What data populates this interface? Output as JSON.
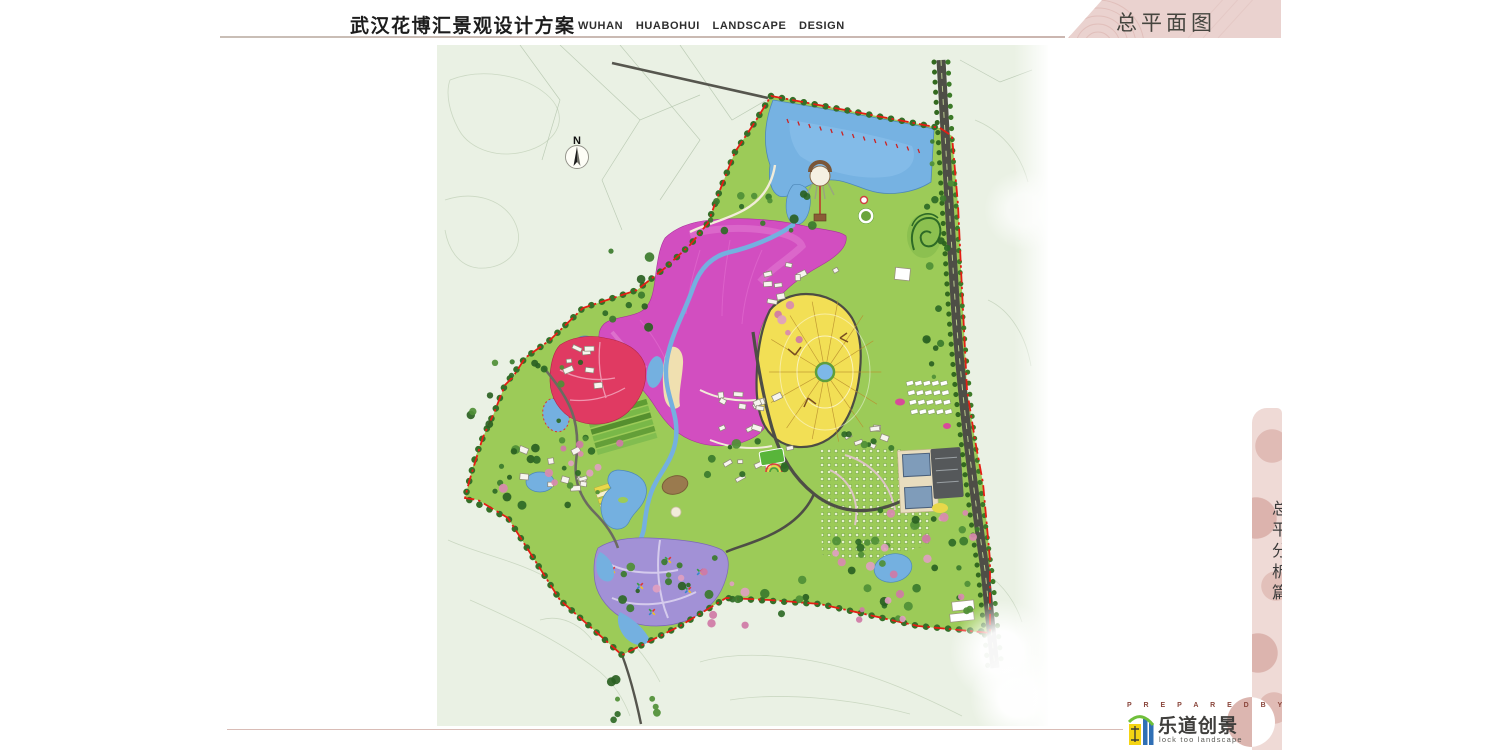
{
  "header": {
    "title": "武汉花博汇景观设计方案",
    "subtitle": "WUHAN  HUABOHUI  LANDSCAPE  DESIGN"
  },
  "banner": {
    "title": "总平面图"
  },
  "side_tab": {
    "title": "总平分析篇"
  },
  "map": {
    "north_label": "N"
  },
  "footer": {
    "prepared_by": "P R E P A R E D   B Y",
    "company_name": "乐道创景",
    "company_tagline": "lock too landscape"
  },
  "colors": {
    "banner_pink": "#ead2cf",
    "ribbon_pink": "#efdad6",
    "boundary_red": "#e41d14",
    "site_green": "#9ccb58",
    "flower_magenta": "#d24ec0",
    "rose_crimson": "#e03a62",
    "garden_yellow": "#f2df55",
    "lavender_purple": "#a291d6",
    "water_blue": "#76b2e2",
    "road_dark": "#4e4e46",
    "logo_yellow": "#f5d413",
    "logo_blue": "#2f6fb5",
    "logo_green": "#6fbf3a"
  }
}
